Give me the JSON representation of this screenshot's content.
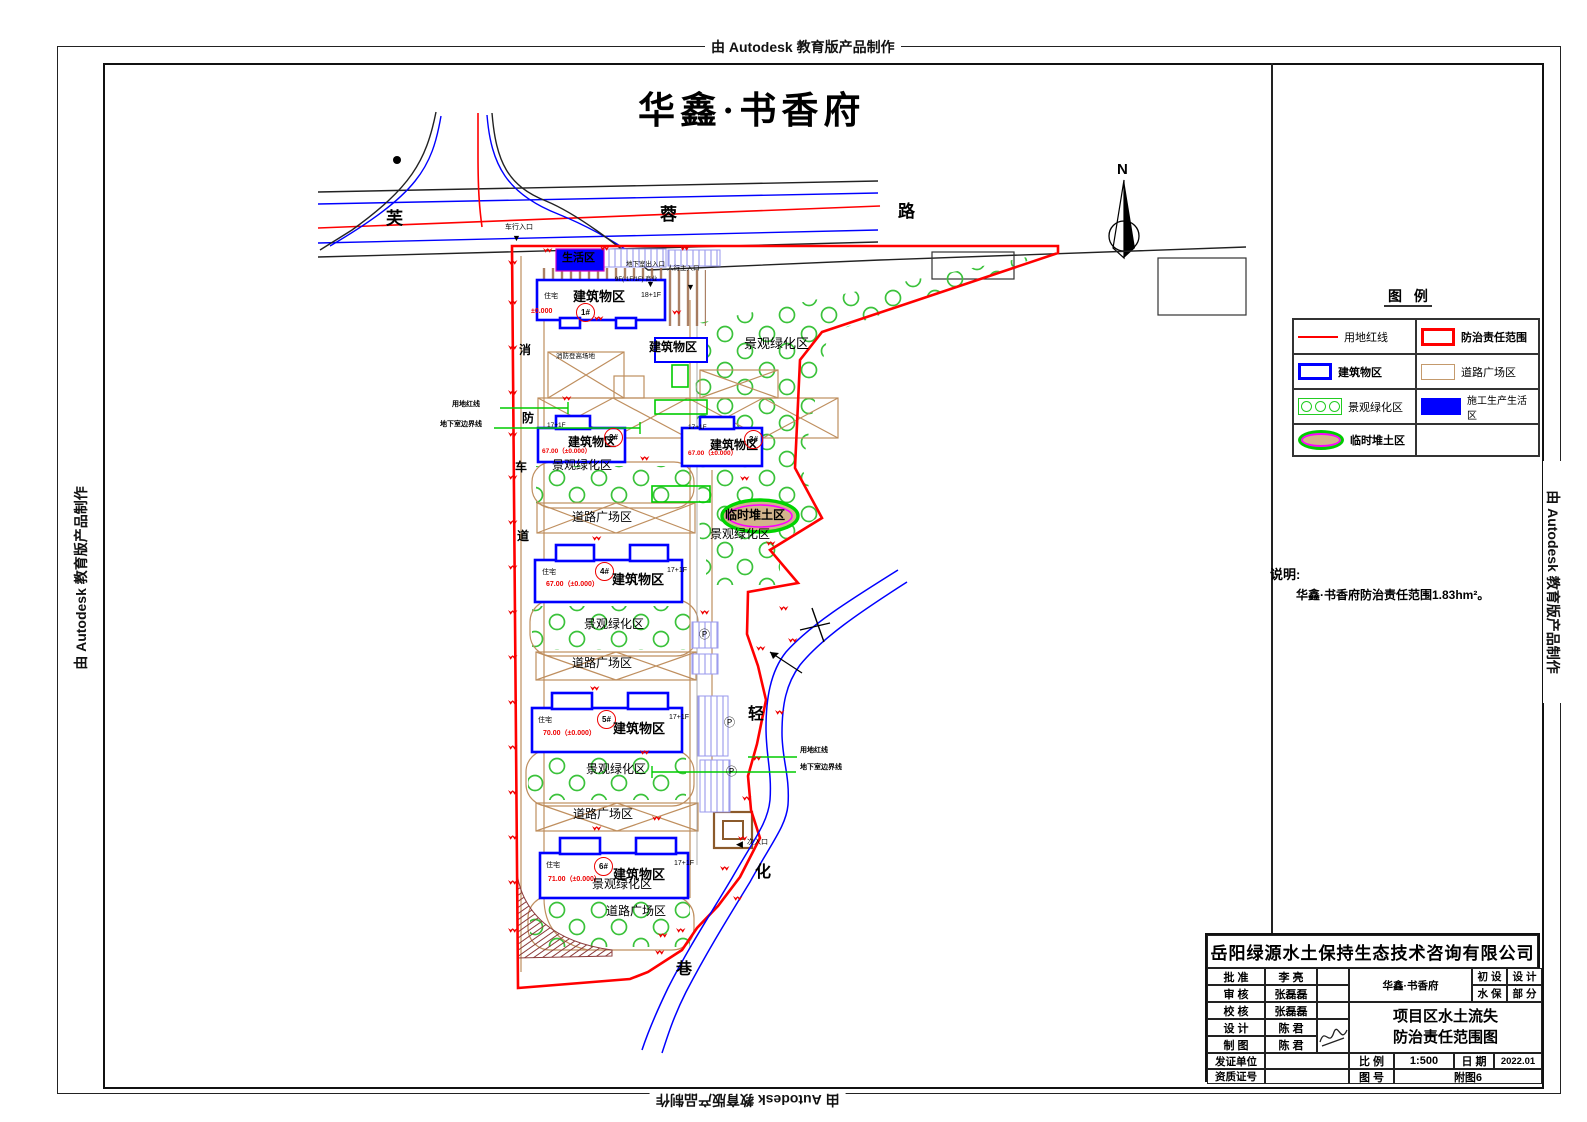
{
  "watermark": "由 Autodesk 教育版产品制作",
  "drawing_title": "华鑫·书香府",
  "north_label": "N",
  "roads": {
    "furong_chars": [
      "芙",
      "蓉",
      "路"
    ],
    "lane_chars": [
      "轻",
      "化",
      "巷"
    ],
    "fire_lane_chars": [
      "消",
      "防",
      "车",
      "道"
    ]
  },
  "entrances": {
    "vehicle": "车行入口",
    "basement": "地下室出入口",
    "pedestrian": "人行主入口",
    "secondary": "次入口",
    "commercial_note": "9F(-1F/1F) 商业",
    "tri_down": "▼",
    "tri_left": "◀"
  },
  "zone_labels": {
    "living": "生活区",
    "building": "建筑物区",
    "green": "景观绿化区",
    "plaza": "道路广场区",
    "temp_soil": "临时堆土区",
    "fire_pad": "消防登高场地"
  },
  "leader_labels": {
    "red_line": "用地红线",
    "basement_line": "地下室边界线"
  },
  "parking_symbol": "Ⓟ",
  "buildings": [
    {
      "no": "1#",
      "use": "住宅",
      "floors": "18+1F",
      "elev": "±0.000"
    },
    {
      "no": "2#",
      "use": "",
      "floors": "17+1F",
      "elev": "67.00（±0.000）"
    },
    {
      "no": "3#",
      "use": "",
      "floors": "17+1F",
      "elev": "67.00（±0.000）"
    },
    {
      "no": "4#",
      "use": "住宅",
      "floors": "17+1F",
      "elev": "67.00（±0.000）"
    },
    {
      "no": "5#",
      "use": "住宅",
      "floors": "17+1F",
      "elev": "70.00（±0.000）"
    },
    {
      "no": "6#",
      "use": "住宅",
      "floors": "17+1F",
      "elev": "71.00（±0.000）"
    }
  ],
  "legend": {
    "title": "图 例",
    "items": [
      {
        "label": "用地红线"
      },
      {
        "label": "防治责任范围"
      },
      {
        "label": "建筑物区"
      },
      {
        "label": "道路广场区"
      },
      {
        "label": "景观绿化区"
      },
      {
        "label": "施工生产生活区"
      },
      {
        "label": "临时堆土区"
      }
    ]
  },
  "notes": {
    "title": "说明:",
    "body": "华鑫·书香府防治责任范围1.83hm²。"
  },
  "titleblock": {
    "company": "岳阳绿源水土保持生态技术咨询有限公司",
    "rows": [
      {
        "label": "批 准",
        "value": "李 亮"
      },
      {
        "label": "审 核",
        "value": "张磊磊"
      },
      {
        "label": "校 核",
        "value": "张磊磊"
      },
      {
        "label": "设 计",
        "value": "陈 君"
      },
      {
        "label": "制 图",
        "value": "陈 君"
      }
    ],
    "cert_label": "发证单位",
    "cert_value": "",
    "qual_label": "资质证号",
    "qual_value": "",
    "project": "华鑫·书香府",
    "stage": [
      [
        "初 设",
        "设 计"
      ],
      [
        "水 保",
        "部 分"
      ]
    ],
    "dwg_title1": "项目区水土流失",
    "dwg_title2": "防治责任范围图",
    "scale_label": "比 例",
    "scale": "1:500",
    "date_label": "日 期",
    "date": "2022.01",
    "figno_label": "图 号",
    "figno": "附图6"
  }
}
